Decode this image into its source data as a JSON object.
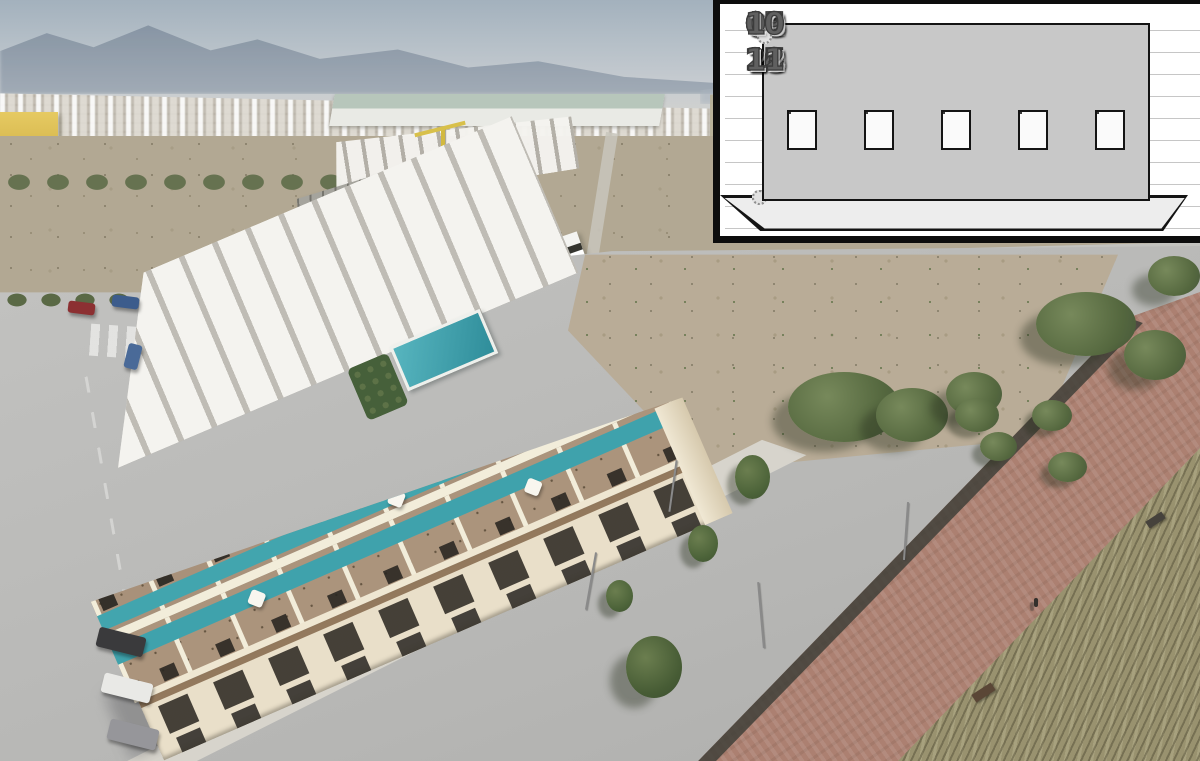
{
  "site_plan": {
    "unit_rows": {
      "top": [
        "20",
        "19",
        "18",
        "17",
        "16",
        "15",
        "14",
        "13",
        "12",
        "11"
      ],
      "bottom": [
        "01",
        "02",
        "03",
        "04",
        "05",
        "06",
        "07",
        "08",
        "09",
        "10"
      ]
    },
    "highlighted_unit": "14",
    "stairwell_count": 5,
    "colors": {
      "panel_background": "#ffffff",
      "frame": "#0d0d0d",
      "unit_fill": "#c8c8c8",
      "highlight_fill": "#a9a9ab",
      "terrace_fill": "#ebebeb",
      "number": "#5a5a5a",
      "deck_lines": "#c6c6c6"
    }
  },
  "photo": {
    "colors": {
      "sky": "#a7b4bf",
      "mountains": "#8593a3",
      "scrubland": "#b2a893",
      "dirt_lot": "#b9ac97",
      "pavement": "#bdbdbd",
      "sidewalk": "#d7d4cc",
      "building_cream": "#e9dfc9",
      "roof_deck": "#a8917a",
      "pool_teal": "#3fa2ac",
      "communal_pool": "#3d9dab",
      "promenade": "#ac8071",
      "dry_grass": "#99926f",
      "trees": "#5c7746",
      "crane_yellow": "#d2b93f",
      "yellow_building": "#d8b94e",
      "warehouse_roof": "#b7c6bb"
    }
  }
}
